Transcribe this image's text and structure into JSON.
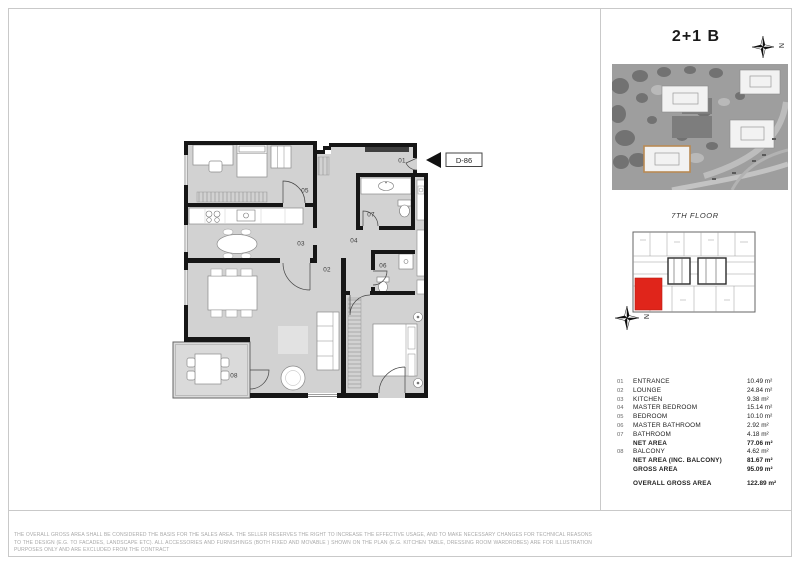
{
  "header": {
    "unit_type": "2+1 B",
    "compass_label": "N"
  },
  "floor_key": {
    "label": "7TH FLOOR",
    "compass_label": "N",
    "highlight_color": "#e0251b"
  },
  "plan": {
    "unit_label": "D-86",
    "room_labels": [
      "01",
      "02",
      "03",
      "04",
      "05",
      "06",
      "07",
      "08"
    ]
  },
  "legend": {
    "rows": [
      {
        "num": "01",
        "name": "ENTRANCE",
        "area": "10.49 m²",
        "bold": false
      },
      {
        "num": "02",
        "name": "LOUNGE",
        "area": "24.84 m²",
        "bold": false
      },
      {
        "num": "03",
        "name": "KITCHEN",
        "area": "9.38 m²",
        "bold": false
      },
      {
        "num": "04",
        "name": "MASTER BEDROOM",
        "area": "15.14 m²",
        "bold": false
      },
      {
        "num": "05",
        "name": "BEDROOM",
        "area": "10.10 m²",
        "bold": false
      },
      {
        "num": "06",
        "name": "MASTER BATHROOM",
        "area": "2.92 m²",
        "bold": false
      },
      {
        "num": "07",
        "name": "BATHROOM",
        "area": "4.18 m²",
        "bold": false
      },
      {
        "num": "",
        "name": "NET AREA",
        "area": "77.06 m²",
        "bold": true
      },
      {
        "num": "08",
        "name": "BALCONY",
        "area": "4.62 m²",
        "bold": false
      },
      {
        "num": "",
        "name": "NET AREA (INC. BALCONY)",
        "area": "81.67 m²",
        "bold": true
      },
      {
        "num": "",
        "name": "GROSS AREA",
        "area": "95.09 m²",
        "bold": true
      },
      {
        "num": "",
        "name": "OVERALL GROSS AREA",
        "area": "122.89 m²",
        "bold": true,
        "gap": true
      }
    ]
  },
  "footer": {
    "disclaimer": "THE OVERALL GROSS AREA SHALL BE CONSIDERED THE BASIS FOR THE SALES AREA. THE SELLER RESERVES THE RIGHT TO INCREASE THE EFFECTIVE USAGE, AND TO MAKE NECESSARY CHANGES FOR TECHNICAL REASONS TO THE DESIGN (E.G. TO FACADES, LANDSCAPE ETC). ALL ACCESSORIES AND FURNISHINGS (BOTH FIXED AND MOVABLE ) SHOWN ON THE PLAN (E.G. KITCHEN TABLE, DRESSING ROOM WARDROBES) ARE FOR ILLUSTRATION PURPOSES ONLY AND ARE EXCLUDED FROM THE CONTRACT"
  },
  "colors": {
    "floor_gray": "#d2d2d2",
    "wall_black": "#161616",
    "site_highlight_outline": "#b98a54"
  }
}
